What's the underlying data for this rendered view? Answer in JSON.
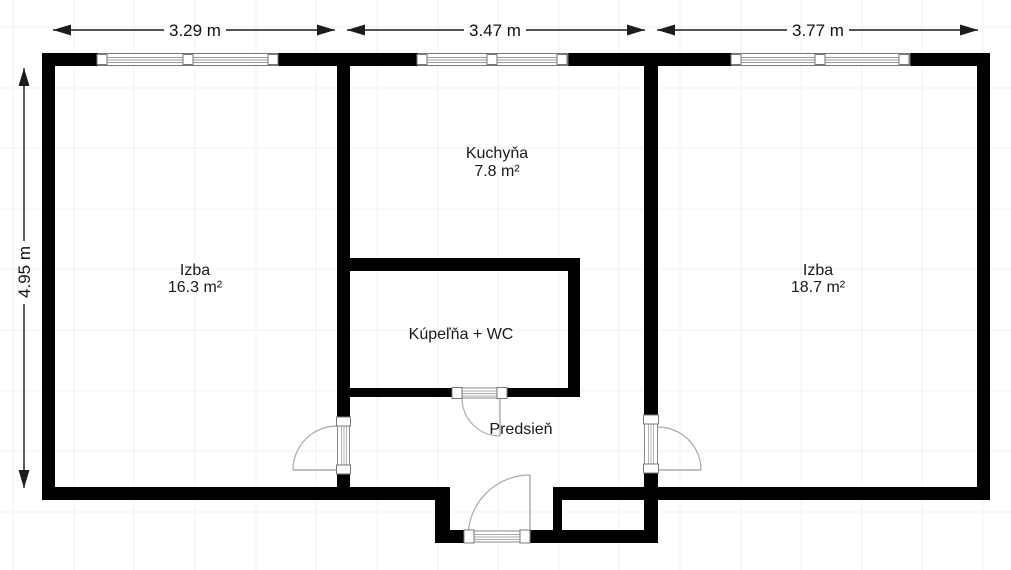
{
  "floor_plan": {
    "title": "2-room apartment floor plan",
    "dimensions_top": [
      {
        "label": "3.29 m"
      },
      {
        "label": "3.47 m"
      },
      {
        "label": "3.77 m"
      }
    ],
    "dimension_left": {
      "label": "4.95 m"
    },
    "rooms": {
      "izba_left": {
        "name": "Izba",
        "area": "16.3 m²"
      },
      "kuchyna": {
        "name": "Kuchyňa",
        "area": "7.8 m²"
      },
      "kupelna": {
        "name": "Kúpeľňa + WC"
      },
      "predsien": {
        "name": "Predsieň"
      },
      "izba_right": {
        "name": "Izba",
        "area": "18.7 m²"
      }
    },
    "colors": {
      "wall": "#000000",
      "background": "#ffffff",
      "grid": "#f1f1f1",
      "dimension": "#1c1c1c",
      "door_swing": "#a8a8a8"
    }
  }
}
